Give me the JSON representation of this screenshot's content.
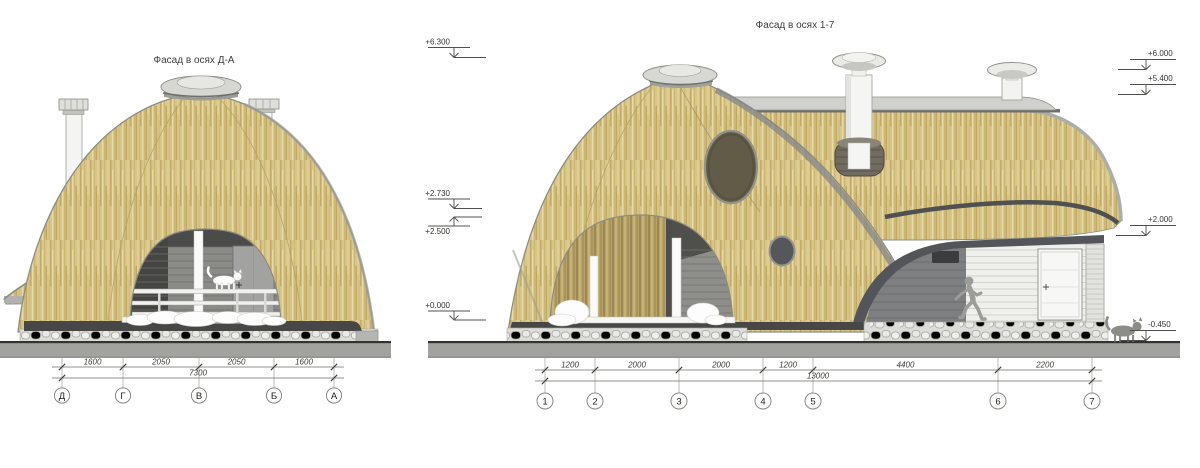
{
  "sheet": {
    "type": "architectural-elevation-sheet",
    "background": "#ffffff"
  },
  "left_drawing": {
    "title": "Фасад в осях Д-А",
    "dimension_segments": [
      "1600",
      "2050",
      "2050",
      "1600"
    ],
    "total_dimension": "7300",
    "axis_labels": [
      "Д",
      "Г",
      "В",
      "Б",
      "А"
    ]
  },
  "right_drawing": {
    "title": "Фасад в осях 1-7",
    "dimension_segments": [
      "1200",
      "2000",
      "2000",
      "1200",
      "4400",
      "2200"
    ],
    "total_dimension": "13000",
    "axis_labels": [
      "1",
      "2",
      "3",
      "4",
      "5",
      "6",
      "7"
    ],
    "elevation_marks_left": [
      "+6.300",
      "+2.730",
      "+2.500",
      "+0.000"
    ],
    "elevation_marks_right": [
      "+6.000",
      "+5.400",
      "+2.000",
      "-0.450"
    ]
  },
  "colors": {
    "thatch_base": "#d8c589",
    "thatch_dark": "#b79d58",
    "thatch_light": "#e8dba6",
    "outline_gray": "#8c8c86",
    "fascia_dark": "#54565a",
    "ground_fill": "#a2a29f",
    "ground_line": "#333331",
    "interior_wall_gray": "#8a8a87",
    "stone_bg": "#dcdcd8",
    "round_window_fill": "#615b48",
    "small_window_fill": "#55575b",
    "chimney_white": "#f4f4f2",
    "skylight_gray": "#d6d6d2",
    "snow_white": "#fdfdfd",
    "figure_gray": "#9c9c99"
  }
}
